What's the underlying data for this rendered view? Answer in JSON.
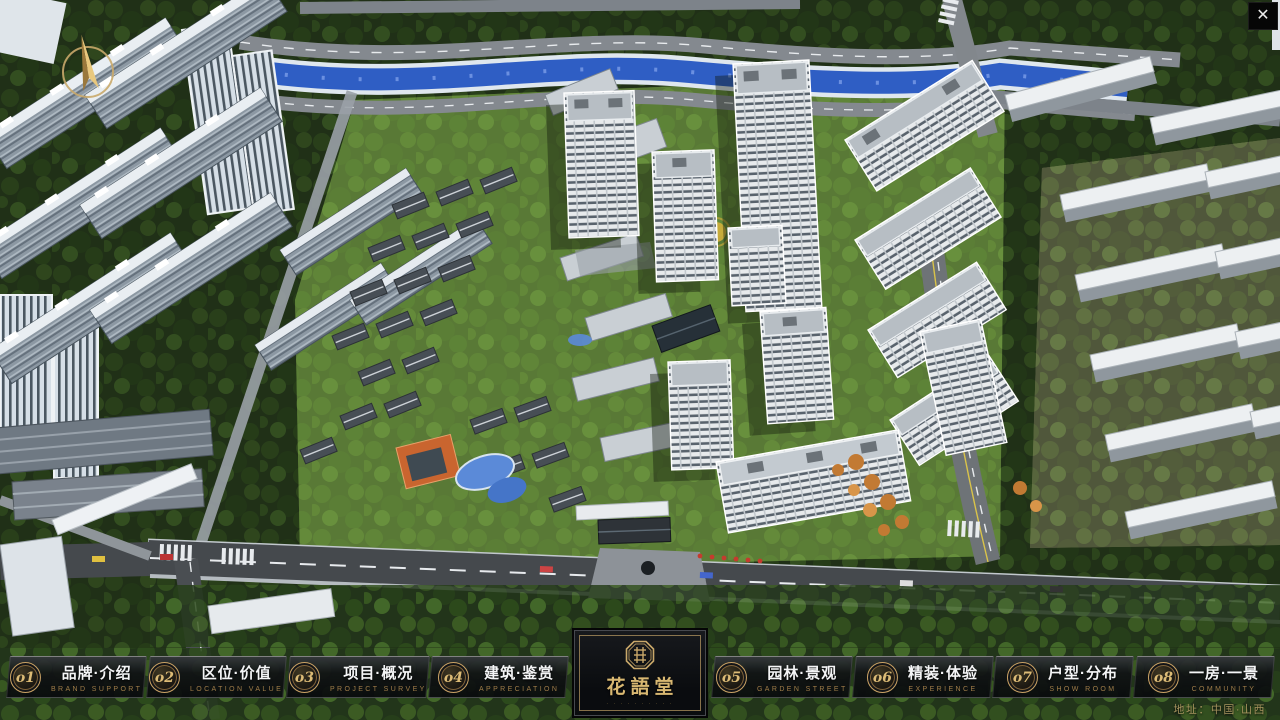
{
  "window": {
    "close_icon": "✕"
  },
  "logo": {
    "name": "花語堂",
    "caption": "· · · · · · · · · ·"
  },
  "nav": {
    "items": [
      {
        "num": "o1",
        "title": "品牌·介绍",
        "subtitle": "BRAND SUPPORT"
      },
      {
        "num": "o2",
        "title": "区位·价值",
        "subtitle": "LOCATION VALUE"
      },
      {
        "num": "o3",
        "title": "项目·概况",
        "subtitle": "PROJECT SURVEY"
      },
      {
        "num": "o4",
        "title": "建筑·鉴赏",
        "subtitle": "APPRECIATION"
      },
      {
        "num": "o5",
        "title": "园林·景观",
        "subtitle": "GARDEN STREET"
      },
      {
        "num": "o6",
        "title": "精装·体验",
        "subtitle": "EXPERIENCE"
      },
      {
        "num": "o7",
        "title": "户型·分布",
        "subtitle": "SHOW ROOM"
      },
      {
        "num": "o8",
        "title": "一房·一景",
        "subtitle": "COMMUNITY"
      }
    ]
  },
  "footer": {
    "address_label": "地址：中国·山西"
  },
  "colors": {
    "gold": "#c9a265",
    "gold_dim": "#a07d49",
    "bar_bg": "#0b0d10",
    "river": "#2f5ec4"
  }
}
